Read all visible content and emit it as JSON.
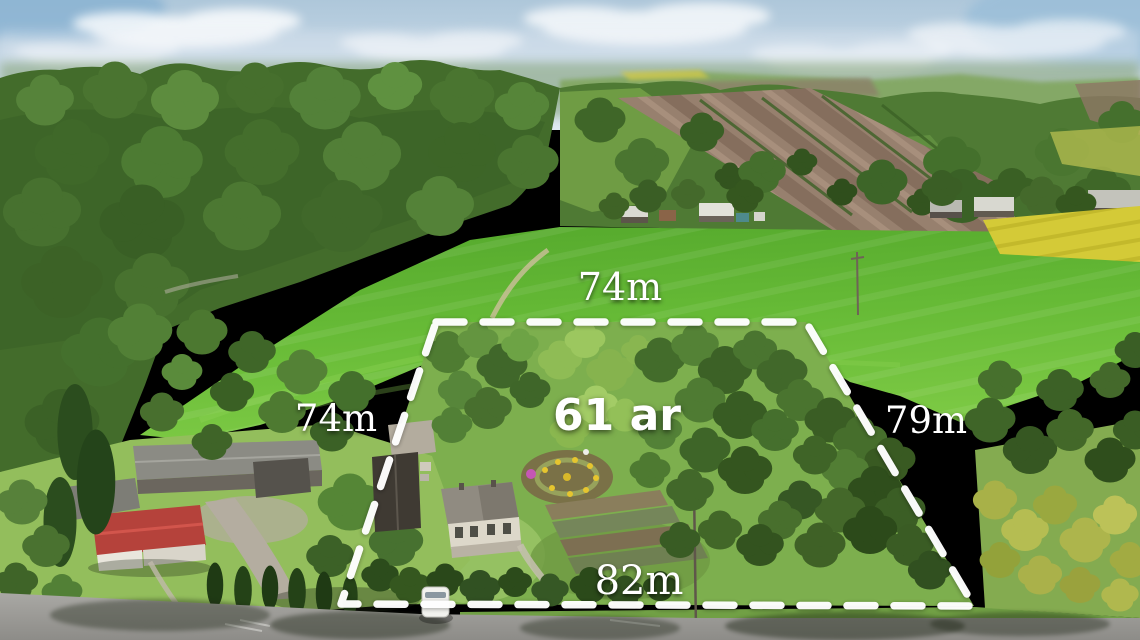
{
  "annotation": {
    "area": "61 ar",
    "top": "74m",
    "left": "74m",
    "right": "79m",
    "bottom": "82m"
  },
  "colors": {
    "boundary_dash": "#ffffff",
    "label_text": "#ffffff",
    "sky_blue": "#c3d6e4",
    "field_green": "#5fb233",
    "forest_green": "#426b2b",
    "rapeseed_yellow": "#d4ca37",
    "plowed_brown": "#97806e",
    "road_gray": "#9a9995",
    "red_roof": "#b5423b"
  }
}
